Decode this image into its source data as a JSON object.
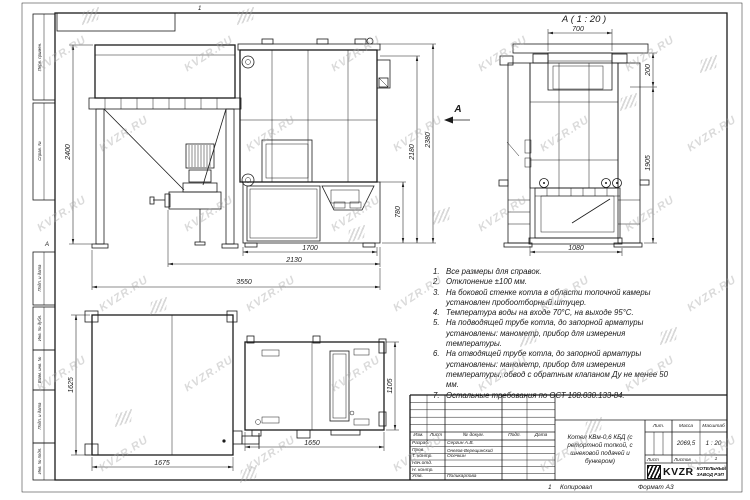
{
  "watermark": {
    "text": "KVZR.RU"
  },
  "frame": {
    "zone_top": "1",
    "zone_left": "А",
    "stamps_top": [
      {
        "label": "Перв. примен."
      },
      {
        "label": "Справ. №"
      }
    ],
    "stamps_bottom": [
      {
        "label": "Подп. и дата"
      },
      {
        "label": "Инв. № дубл."
      },
      {
        "label": "Взам. инв. №"
      },
      {
        "label": "Подп. и дата"
      },
      {
        "label": "Инв. № подл."
      }
    ],
    "footer": {
      "zone": "1",
      "copied": "Копировал",
      "format": "Формат А3"
    }
  },
  "views": {
    "side": {
      "arrow_label": "А",
      "dims": {
        "h2400": "2400",
        "h2380": "2380",
        "h2180": "2180",
        "h780": "780",
        "w1700": "1700",
        "w2130": "2130",
        "w3550": "3550"
      }
    },
    "rear": {
      "title": "А ( 1 : 20 )",
      "dims": {
        "w700": "700",
        "h200": "200",
        "h1905": "1905",
        "w1080": "1080"
      }
    },
    "plan": {
      "dims": {
        "h1625": "1625",
        "w1675": "1675",
        "w1650": "1650",
        "h1105": "1105"
      }
    }
  },
  "notes": [
    {
      "num": "1.",
      "text": "Все размеры для справок."
    },
    {
      "num": "2.",
      "text": "Отклонение ±100 мм."
    },
    {
      "num": "3.",
      "text": "На боковой стенке котла в области топочной камеры установлен пробоотборный штуцер."
    },
    {
      "num": "4.",
      "text": "Температура воды на входе 70°С, на выходе 95°С."
    },
    {
      "num": "5.",
      "text": "На подводящей трубе котла, до запорной арматуры установлены: манометр, прибор для измерения температуры."
    },
    {
      "num": "6.",
      "text": "На отводящей трубе котла, до запорной арматуры установлены: манометр, прибор для измерения температуры, обвод с обратным клапаном Ду не менее 50 мм."
    },
    {
      "num": "7.",
      "text": "Остальные требования по ОСТ 108.030.133-84."
    }
  ],
  "title_block": {
    "header": {
      "izm": "Изм.",
      "list": "Лист",
      "doc": "№ докум.",
      "podp": "Подп.",
      "date": "Дата"
    },
    "rows": [
      {
        "role": "Разраб.",
        "name": "Сергин А.В."
      },
      {
        "role": "Пров.",
        "name": "Онегов-Верещинский"
      },
      {
        "role": "Т. контр.",
        "name": "Осечкин"
      },
      {
        "role": "Нач.отд.",
        "name": ""
      },
      {
        "role": "Н. контр.",
        "name": ""
      },
      {
        "role": "Утв.",
        "name": "Поликарпова"
      }
    ],
    "title": "Котел КВм-0,6 КБД (с ретортной топкой, с шнековой подачей и бункером)",
    "lit_label": "Лит.",
    "mass_label": "Масса",
    "mass_value": "2069,5",
    "scale_label": "Масштаб",
    "scale_value": "1 : 20",
    "sheet_label": "Лист",
    "sheets_label": "Листов",
    "sheets_value": "1",
    "company": {
      "logo": "KVZR",
      "line1": "КОТЕЛЬНЫЙ",
      "line2": "ЗАВОД РЭП"
    }
  }
}
